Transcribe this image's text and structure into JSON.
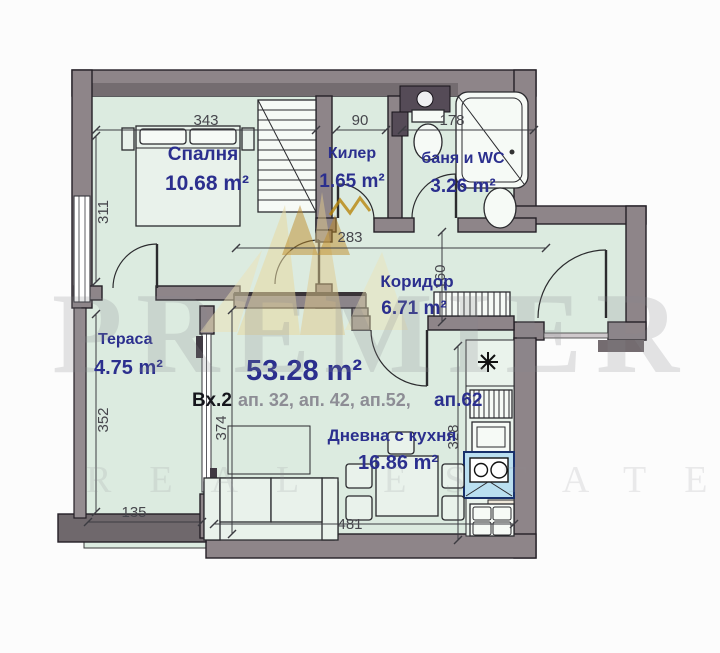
{
  "plan": {
    "total_area": "53.28 m²",
    "entrance": "Вх.2",
    "apartments": "ап. 32, ап. 42, ап.52,",
    "apartment_highlight": "ап.62",
    "rooms": {
      "bedroom": {
        "name": "Спалня",
        "area": "10.68 m²"
      },
      "closet": {
        "name": "Килер",
        "area": "1.65 m²"
      },
      "bathroom": {
        "name": "баня и WC",
        "area": "3.26 m²"
      },
      "corridor": {
        "name": "Коридор",
        "area": "6.71 m²"
      },
      "terrace": {
        "name": "Тераса",
        "area": "4.75 m²"
      },
      "living": {
        "name": "Дневна с кухня",
        "area": "16.86 m²"
      }
    },
    "dimensions": {
      "bedroom_width": "343",
      "bedroom_height": "311",
      "closet_width": "90",
      "bathroom_width": "178",
      "corridor_width": "283",
      "corridor_height": "160",
      "terrace_height": "352",
      "terrace_width": "135",
      "living_height_left": "374",
      "living_height_right": "328",
      "living_width": "481"
    }
  },
  "watermark": {
    "brand": "PREMIER",
    "tagline": "REAL ESTATE"
  },
  "colors": {
    "label_navy": "#2b2f8e",
    "wall_gray": "#8e8589",
    "floor_green": "#dcebe0",
    "sink_highlight": "#badff0",
    "watermark_gold": "#d9b04c"
  }
}
